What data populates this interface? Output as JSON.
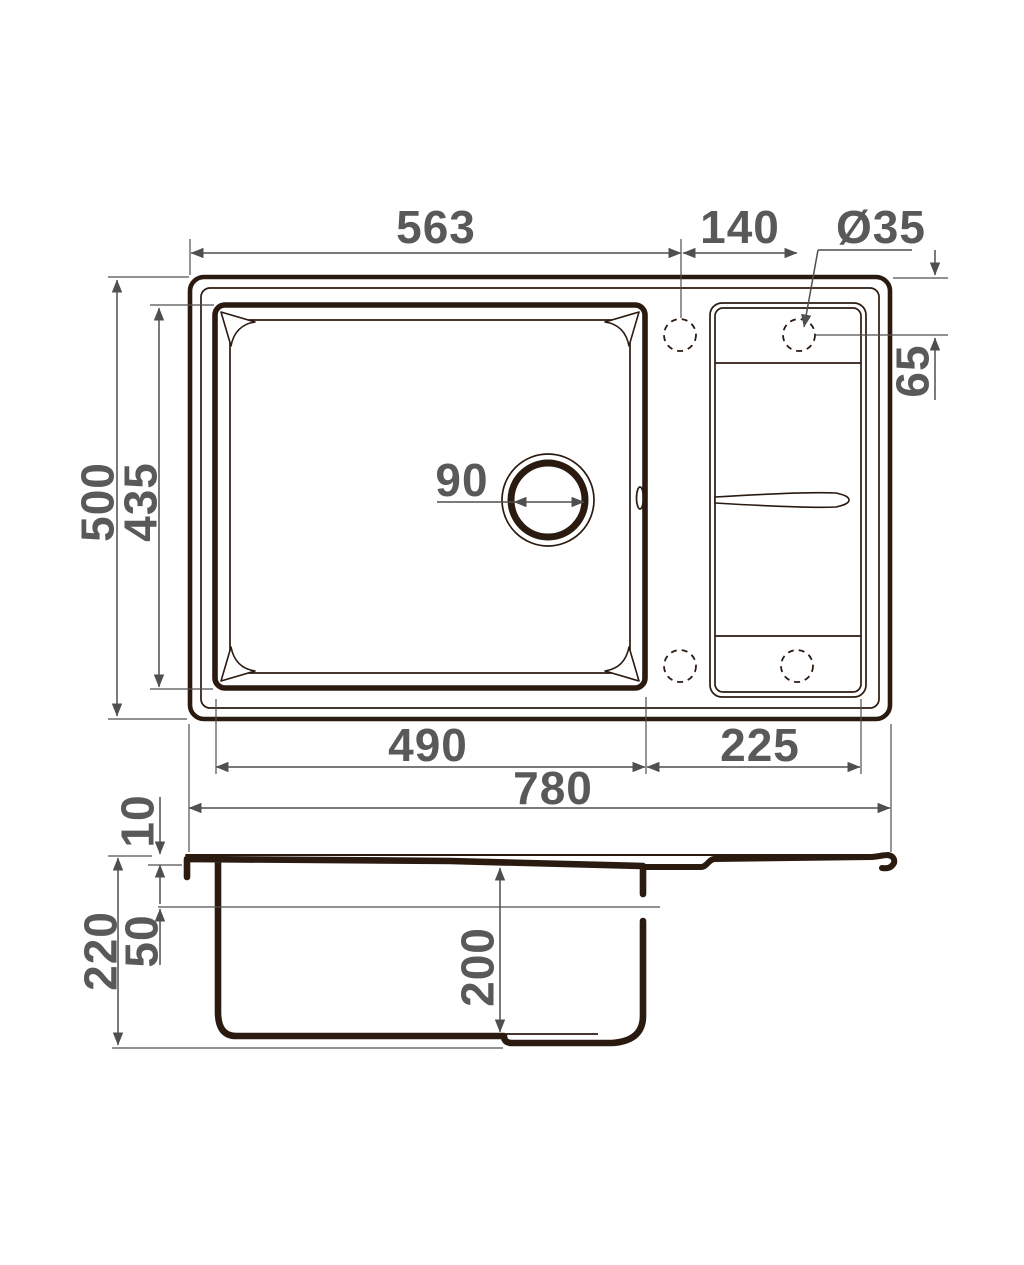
{
  "drawing": {
    "type": "kitchen-sink dimensional drawing",
    "colors": {
      "line": "#2b1a10",
      "dim_line": "#4f4f4f",
      "dim_text": "#595959",
      "background": "#ffffff"
    },
    "top_view": {
      "dimensions": {
        "overall_width": "780",
        "overall_length": "500",
        "bowl_length": "435",
        "bowl_width": "490",
        "drainboard_width": "225",
        "edge_to_hole": "563",
        "hole_spacing": "140",
        "hole_diameter": "Ø35",
        "hole_edge_offset": "65",
        "drain_diameter": "90"
      }
    },
    "side_view": {
      "dimensions": {
        "rim_thickness": "10",
        "ledge_depth": "50",
        "overall_depth": "220",
        "bowl_depth": "200"
      }
    }
  }
}
